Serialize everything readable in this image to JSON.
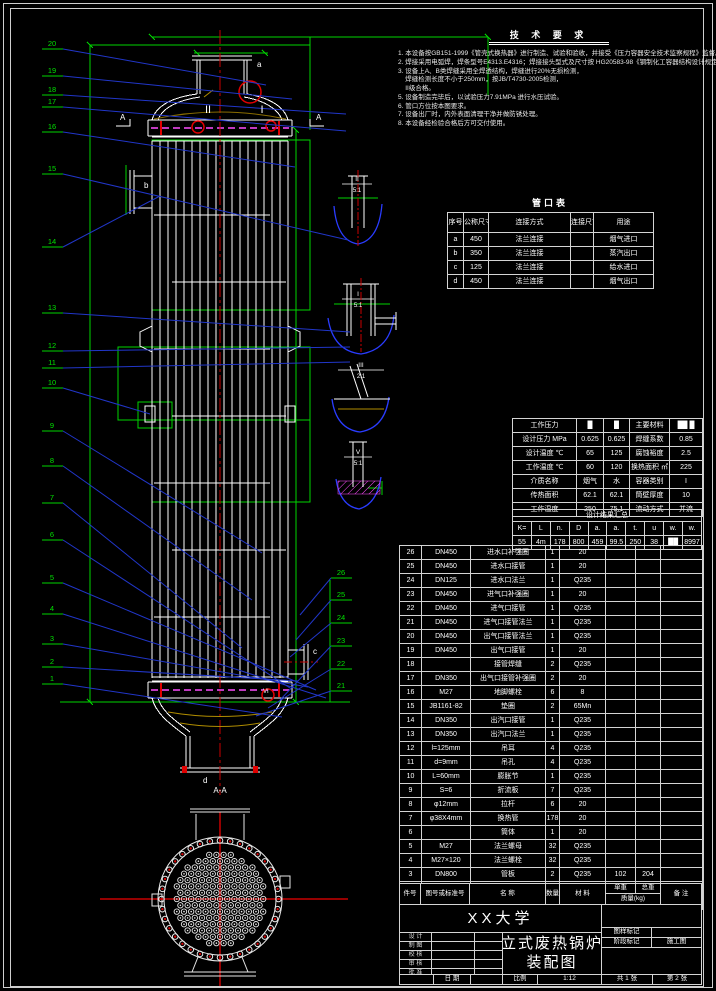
{
  "labels": {
    "nozzle_a": "a",
    "nozzle_b": "b",
    "nozzle_c": "c",
    "nozzle_d": "d",
    "section_mark_left": "A",
    "section_mark_right": "A",
    "section_title": "A-A",
    "weld_detail_2": "II",
    "weld_detail_1": "I",
    "weld_detail_6": "VI"
  },
  "tech_requirements": {
    "title": "技 术 要 求",
    "lines": [
      "1. 本设备按GB151-1999《管壳式换热器》进行制造、试验和验收，并接受《压力容器安全技术监察规程》监督。",
      "2. 焊接采用电弧焊，焊条型号E4313.E4316；焊接接头型式及尺寸按 HG20583-98《钢制化工容器结构设计规定》。",
      "3. 设备上A、B类焊缝采用全焊透结构，焊缝进行20%无损检测，",
      "    焊缝检测长度不小于250mm，按JB/T4730-2005检测，",
      "    II级合格。",
      "5. 设备制造完毕后，以试验压力7.91MPa 进行水压试验。",
      "6. 管口方位按本图要求。",
      "7. 设备出厂时，内外表面清理干净并做防锈处理。",
      "8. 本设备经检验合格后方可交付使用。"
    ]
  },
  "nozzle_table": {
    "title": "管口表",
    "headers": [
      "序号",
      "公称尺寸",
      "连接方式",
      "连接尺寸",
      "用途"
    ],
    "rows": [
      [
        "a",
        "450",
        "法兰连接",
        "",
        "烟气进口"
      ],
      [
        "b",
        "350",
        "法兰连接",
        "",
        "蒸汽出口"
      ],
      [
        "c",
        "125",
        "法兰连接",
        "",
        "给水进口"
      ],
      [
        "d",
        "450",
        "法兰连接",
        "",
        "烟气出口"
      ]
    ]
  },
  "param_table": {
    "rows": [
      [
        "工作压力",
        "█",
        "█",
        "主要材料",
        "██ █"
      ],
      [
        "设计压力 MPa",
        "0.625",
        "0.625",
        "焊缝系数",
        "0.85"
      ],
      [
        "设计温度 ℃",
        "65",
        "125",
        "腐蚀裕度",
        "2.5"
      ],
      [
        "工作温度 ℃",
        "60",
        "120",
        "换热面积 ㎡",
        "225"
      ],
      [
        "介质名称",
        "烟气",
        "水",
        "容器类别",
        "I"
      ],
      [
        "传热面积",
        "62.1",
        "62.1",
        "筒壁厚度",
        "10"
      ],
      [
        "工作温度",
        "250",
        "75.1",
        "流动方式",
        "并流"
      ]
    ],
    "summary_title": "设计结果汇总",
    "summary": [
      [
        "K=",
        "L",
        "n.",
        "D",
        "a.",
        "a.",
        "t.",
        "u",
        "w.",
        "w."
      ],
      [
        "55",
        "4m",
        "178",
        "800",
        "459",
        "99.5",
        "250",
        "38",
        "██",
        "8997"
      ]
    ]
  },
  "bom": {
    "headers": [
      "件号",
      "图号或标准号",
      "名 称",
      "数量",
      "材 料",
      "单重",
      "总重",
      "备 注"
    ],
    "mass_header": "质量(kg)",
    "rows": [
      [
        "26",
        "DN450",
        "进水口补强圈",
        "1",
        "20",
        "",
        "",
        ""
      ],
      [
        "25",
        "DN450",
        "进水口接管",
        "1",
        "20",
        "",
        "",
        ""
      ],
      [
        "24",
        "DN125",
        "进水口法兰",
        "1",
        "Q235",
        "",
        "",
        ""
      ],
      [
        "23",
        "DN450",
        "进气口补强圈",
        "1",
        "20",
        "",
        "",
        ""
      ],
      [
        "22",
        "DN450",
        "进气口接管",
        "1",
        "Q235",
        "",
        "",
        ""
      ],
      [
        "21",
        "DN450",
        "进气口接管法兰",
        "1",
        "Q235",
        "",
        "",
        ""
      ],
      [
        "20",
        "DN450",
        "出气口接管法兰",
        "1",
        "Q235",
        "",
        "",
        ""
      ],
      [
        "19",
        "DN450",
        "出气口接管",
        "1",
        "20",
        "",
        "",
        ""
      ],
      [
        "18",
        "",
        "接管焊缝",
        "2",
        "Q235",
        "",
        "",
        ""
      ],
      [
        "17",
        "DN350",
        "出气口接管补强圈",
        "2",
        "20",
        "",
        "",
        ""
      ],
      [
        "16",
        "M27",
        "地脚螺栓",
        "6",
        "8",
        "",
        "",
        ""
      ],
      [
        "15",
        "JB1161-82",
        "垫圈",
        "2",
        "65Mn",
        "",
        "",
        ""
      ],
      [
        "14",
        "DN350",
        "出汽口接管",
        "1",
        "Q235",
        "",
        "",
        ""
      ],
      [
        "13",
        "DN350",
        "出汽口法兰",
        "1",
        "Q235",
        "",
        "",
        ""
      ],
      [
        "12",
        "l=125mm",
        "吊耳",
        "4",
        "Q235",
        "",
        "",
        ""
      ],
      [
        "11",
        "d=9mm",
        "吊孔",
        "4",
        "Q235",
        "",
        "",
        ""
      ],
      [
        "10",
        "L=60mm",
        "膨胀节",
        "1",
        "Q235",
        "",
        "",
        ""
      ],
      [
        "9",
        "S=6",
        "折流板",
        "7",
        "Q235",
        "",
        "",
        ""
      ],
      [
        "8",
        "φ12mm",
        "拉杆",
        "6",
        "20",
        "",
        "",
        ""
      ],
      [
        "7",
        "φ38X4mm",
        "换热管",
        "178",
        "20",
        "",
        "",
        ""
      ],
      [
        "6",
        "",
        "筒体",
        "1",
        "20",
        "",
        "",
        ""
      ],
      [
        "5",
        "M27",
        "法兰螺母",
        "32",
        "Q235",
        "",
        "",
        ""
      ],
      [
        "4",
        "M27×120",
        "法兰螺栓",
        "32",
        "Q235",
        "",
        "",
        ""
      ],
      [
        "3",
        "DN800",
        "管板",
        "2",
        "Q235",
        "102",
        "204",
        ""
      ],
      [
        "2",
        "DN800",
        "管板法兰",
        "2",
        "Q235",
        "44.28",
        "88.56",
        ""
      ],
      [
        "1",
        "DN800",
        "封头",
        "2",
        "Q235",
        "36",
        "72",
        ""
      ]
    ]
  },
  "title_block": {
    "company": "XX大学",
    "title_line1": "立式废热锅炉",
    "title_line2": "装配图",
    "sign_labels": [
      "设 计",
      "制 图",
      "校 核",
      "审 核",
      "批 准"
    ],
    "date_label": "日 期",
    "scale_label": "比例",
    "scale_value": "1:12",
    "mark_label": "图样标记",
    "stage_label": "阶段标记",
    "stage_value": "施工图",
    "sheet_total": "共 1 张",
    "sheet_no": "第 2 张"
  },
  "callouts": {
    "left": [
      "20",
      "19",
      "18",
      "17",
      "16",
      "15",
      "14",
      "13",
      "12",
      "11",
      "10",
      "9",
      "8",
      "7",
      "6",
      "5",
      "4",
      "3",
      "2",
      "1"
    ],
    "right": [
      "26",
      "25",
      "24",
      "23",
      "22",
      "21"
    ]
  },
  "details": [
    {
      "label": "II",
      "scale": "5:1"
    },
    {
      "label": "I",
      "scale": "5:1"
    },
    {
      "label": "III",
      "scale": "2:1"
    },
    {
      "label": "V",
      "scale": "5:1"
    }
  ]
}
